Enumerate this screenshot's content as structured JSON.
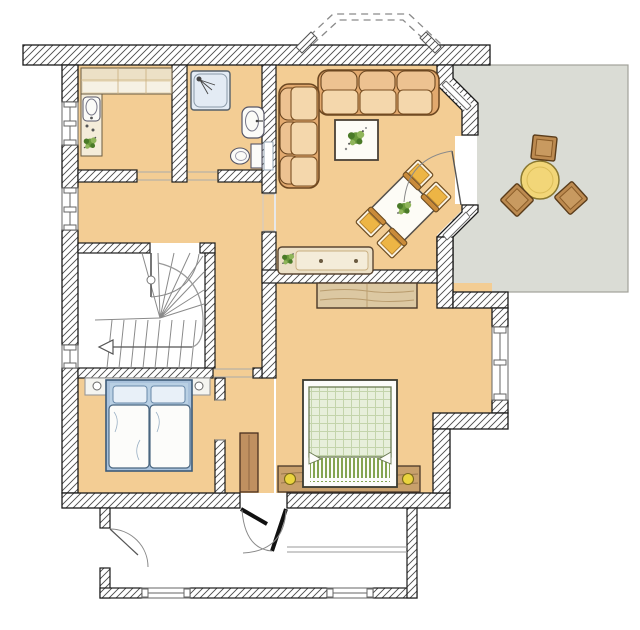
{
  "meta": {
    "type": "floor-plan",
    "description": "hand-drawn architectural floor plan, ground floor with terrace"
  },
  "colors": {
    "floor": "#f3cd94",
    "terrace": "#dadcd5",
    "terrace_border": "#a2a29a",
    "wall_line": "#1a1a1a",
    "hatch_line": "#4a4a4a",
    "wood": "#ece0c6",
    "wood_inner": "#f4ecd9",
    "sofa_base": "#e2a96e",
    "sofa_back": "#edc291",
    "sofa_seat": "#f4d7ac",
    "chair_cushion": "#edb545",
    "surface_white": "#fdfcf6",
    "plant_dark": "#4a7a28",
    "plant_mid": "#6b9a3c",
    "plant_light": "#8fb55a",
    "shower": "#e3ebf4",
    "bed1_frame": "#a9c2dc",
    "bed1_pillow_band": "#b9d0e4",
    "bed1_pillow": "#e8f0f8",
    "duvet": "#fcfcfa",
    "blanket": "#e7efdb",
    "blanket_grid": "#c3d4ab",
    "fringe": "#6f9433",
    "headboard": "#c8a06c",
    "lamp": "#ead43e",
    "wardrobe": "#dcc8a2",
    "cupboard": "#c09060",
    "table_yellow": "#f2d678",
    "chair_brown": "#bc8a50",
    "stair_line": "#8a8a8a",
    "door_line": "#8a8a8a",
    "dashed_line": "#8a8a8a",
    "headboard_shelf": "#f4f4f0"
  },
  "rooms": [
    {
      "id": "kitchen",
      "furniture": [
        "counter",
        "sink",
        "hob",
        "plant"
      ]
    },
    {
      "id": "bathroom",
      "furniture": [
        "shower",
        "washbasin",
        "toilet",
        "radiator"
      ]
    },
    {
      "id": "hall",
      "furniture": []
    },
    {
      "id": "living-dining-room",
      "furniture": [
        "corner-sofa",
        "coffee-table-with-plant",
        "dining-table",
        "dining-chairs-x4",
        "sideboard-with-plant",
        "terrace-door"
      ]
    },
    {
      "id": "staircase",
      "furniture": [
        "winder-stairs",
        "direction-arrow",
        "apartment-door"
      ]
    },
    {
      "id": "bedroom-guest",
      "furniture": [
        "double-bed",
        "headboard-shelf"
      ]
    },
    {
      "id": "bedroom-master",
      "furniture": [
        "double-bed",
        "wardrobe",
        "tall-cupboard",
        "bedside-lamps-x2"
      ]
    },
    {
      "id": "terrace",
      "furniture": [
        "round-table",
        "chairs-x3"
      ]
    },
    {
      "id": "entrance-vestibule",
      "furniture": [
        "double-entrance-door",
        "side-door",
        "windows-x2"
      ]
    }
  ],
  "counts": {
    "windows_left_wall": 3,
    "dining_chairs": 4,
    "terrace_chairs": 3,
    "beds": 2
  }
}
